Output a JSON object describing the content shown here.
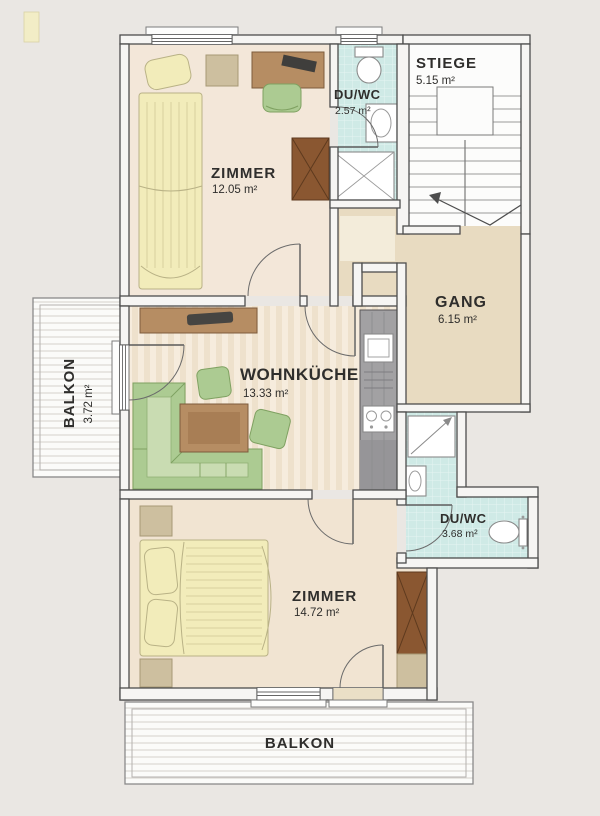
{
  "plan": {
    "rooms": {
      "zimmer_top": {
        "name": "ZIMMER",
        "area": "12.05 m²"
      },
      "du_wc_top": {
        "name": "DU/WC",
        "area": "2.57 m²"
      },
      "stiege": {
        "name": "STIEGE",
        "area": "5.15 m²"
      },
      "gang": {
        "name": "GANG",
        "area": "6.15 m²"
      },
      "wohnkueche": {
        "name": "WOHNKÜCHE",
        "area": "13.33 m²"
      },
      "du_wc_bottom": {
        "name": "DU/WC",
        "area": "3.68 m²"
      },
      "zimmer_bottom": {
        "name": "ZIMMER",
        "area": "14.72 m²"
      },
      "balkon_left": {
        "name": "BALKON",
        "area": "3.72 m²"
      },
      "balkon_bottom": {
        "name": "BALKON"
      }
    },
    "colors": {
      "background": "#eae7e3",
      "floor_beige": "#f3e7d9",
      "floor_tan": "#e8dbc1",
      "bath_cyan": "#cfeae6",
      "furniture_green": "#accb92",
      "wood_brown": "#b68d63",
      "wood_dark": "#8a5731",
      "bed_yellow": "#f2ecba",
      "kitchen_gray": "#a2a1a3"
    }
  }
}
